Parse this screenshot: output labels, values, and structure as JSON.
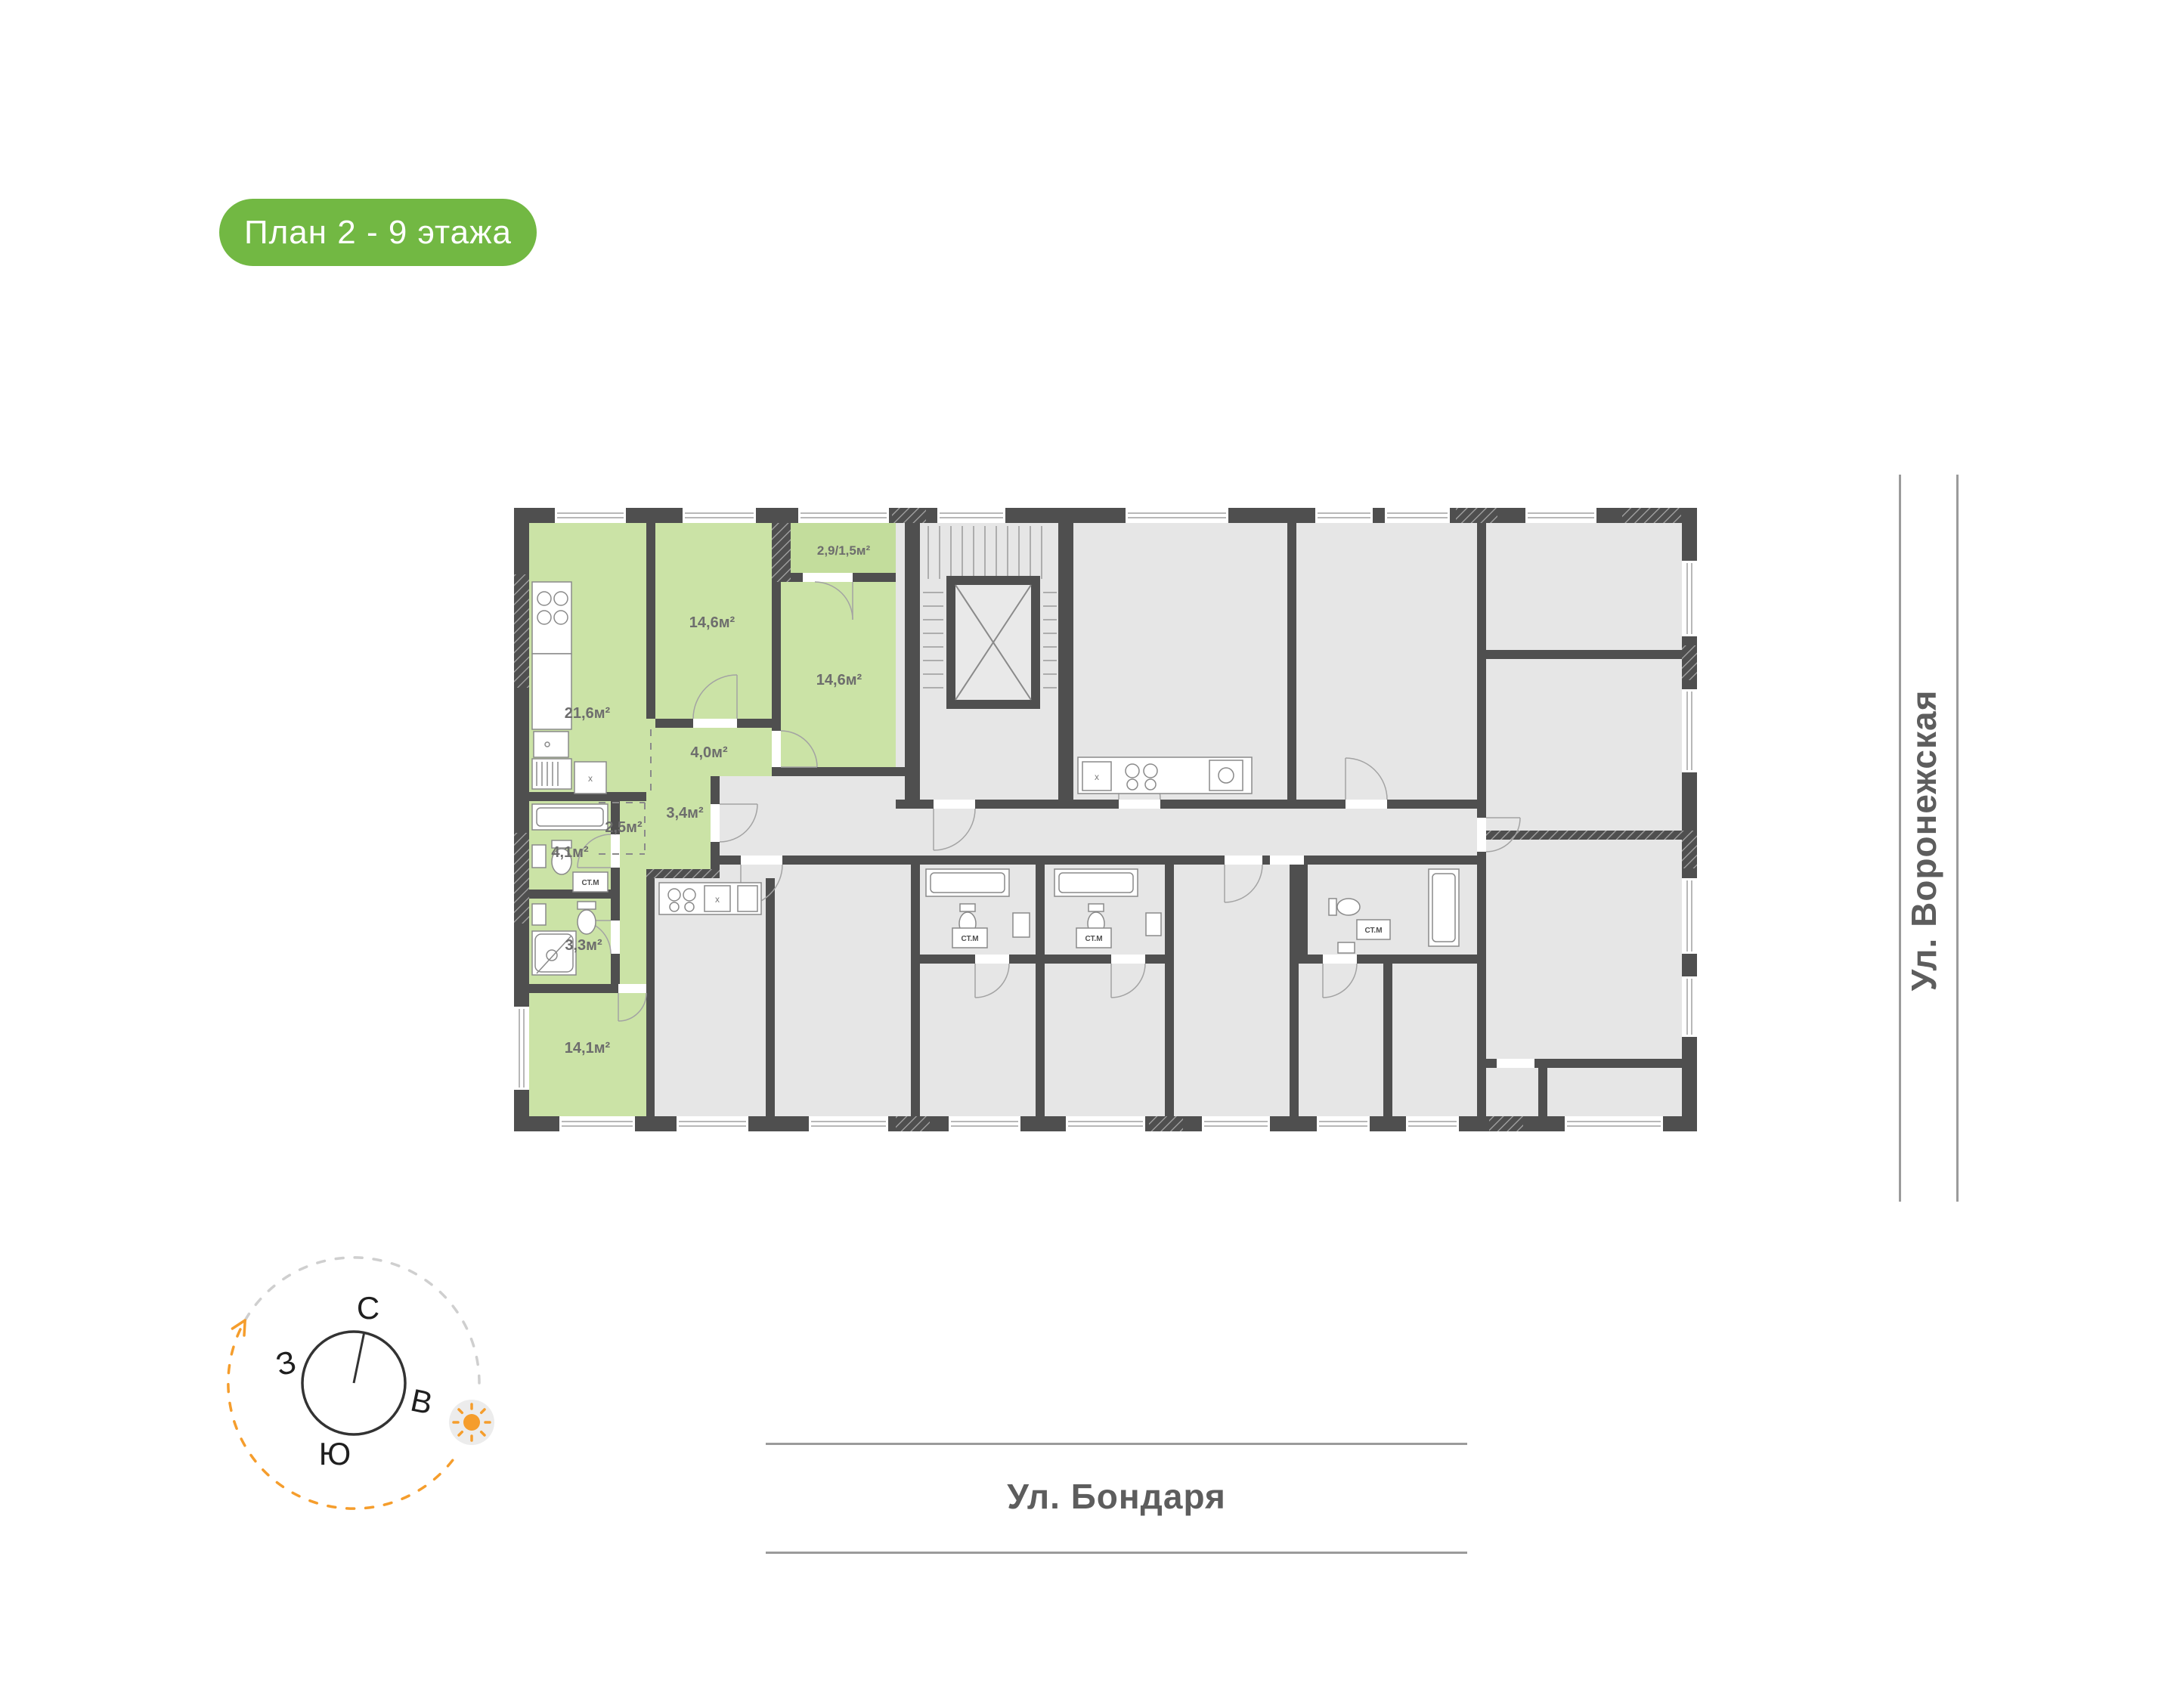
{
  "badge": {
    "label": "План 2 - 9 этажа"
  },
  "plan": {
    "highlight_apartment": {
      "rooms": [
        {
          "name": "kitchen-living",
          "area": "21,6м²"
        },
        {
          "name": "bedroom-top",
          "area": "14,6м²"
        },
        {
          "name": "bedroom-right",
          "area": "14,6м²"
        },
        {
          "name": "balcony",
          "area": "2,9/1,5м²"
        },
        {
          "name": "hallway",
          "area": "4,0м²"
        },
        {
          "name": "wardrobe",
          "area": "2,5м²"
        },
        {
          "name": "hall-entry",
          "area": "3,4м²"
        },
        {
          "name": "bathroom",
          "area": "4,1м²"
        },
        {
          "name": "shower-room",
          "area": "3,3м²"
        },
        {
          "name": "bedroom-bottom",
          "area": "14,1м²"
        }
      ]
    },
    "washer_label": "СТ.М",
    "kitchen_mark": "х"
  },
  "streets": {
    "right": "Ул. Воронежская",
    "bottom": "Ул. Бондаря"
  },
  "compass": {
    "north": "С",
    "east": "В",
    "south": "Ю",
    "west": "З"
  },
  "colors": {
    "badge_green": "#72b843",
    "apartment_green": "#cbe3a6",
    "wall": "#4f4f4f",
    "room_gray": "#e6e6e6",
    "accent_orange": "#f59d2c"
  }
}
